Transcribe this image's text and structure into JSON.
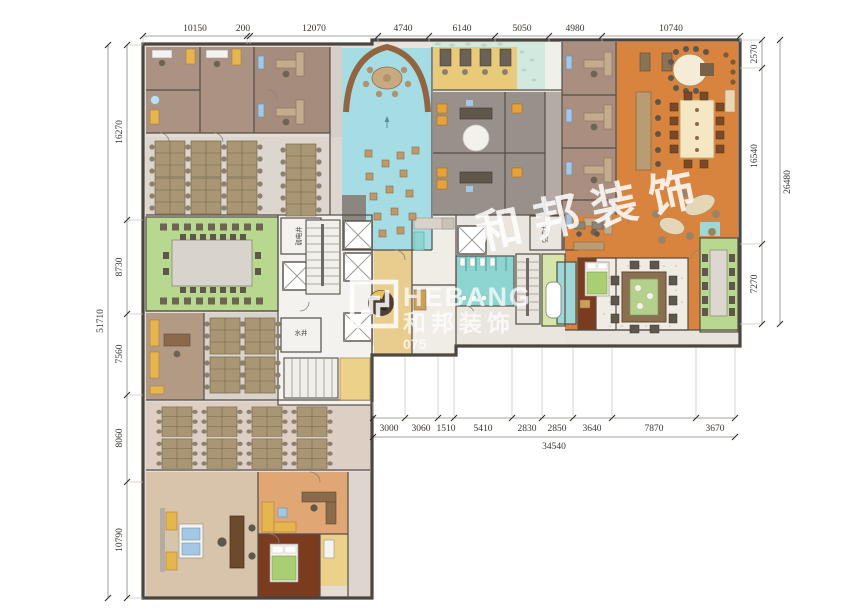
{
  "document": {
    "type": "office-floor-plan",
    "units": "mm"
  },
  "watermark": {
    "brand_en": "HEBANG",
    "brand_cn": "和邦装饰",
    "phone_partial": "075",
    "diagonal_text": "和 邦 装 饰"
  },
  "dimensions": {
    "top": [
      "10150",
      "200",
      "12070",
      "4740",
      "6140",
      "5050",
      "4980",
      "10740"
    ],
    "left": [
      "16270",
      "8730",
      "7560",
      "8060",
      "10790"
    ],
    "left_total": "51710",
    "right": [
      "2570",
      "16540",
      "7270"
    ],
    "right_total": "26480",
    "bottom": [
      "3000",
      "3060",
      "1510",
      "5410",
      "2830",
      "2850",
      "3640",
      "7870",
      "3670"
    ],
    "bottom_total": "34540"
  },
  "labels": {
    "weak_current_shaft": "弱电井",
    "strong_current_shaft": "强电井",
    "water_shaft": "水井"
  },
  "colors": {
    "wall": "#544e47",
    "office_brown": "#ac9283",
    "open_office_grey": "#dcd6cf",
    "lobby_blue": "#a6dce3",
    "meeting_green": "#b7d88e",
    "hall_orange": "#d8843e",
    "booth_yellow": "#e9ca7a",
    "exec_tan": "#d8c3ab",
    "bedroom_wood": "#7b3b1f",
    "restroom_cyan": "#8ed5d1",
    "dining_dots": "#f1ece3",
    "accent_yellow": "#e5b54e",
    "dimension_text": "#3a3530"
  }
}
